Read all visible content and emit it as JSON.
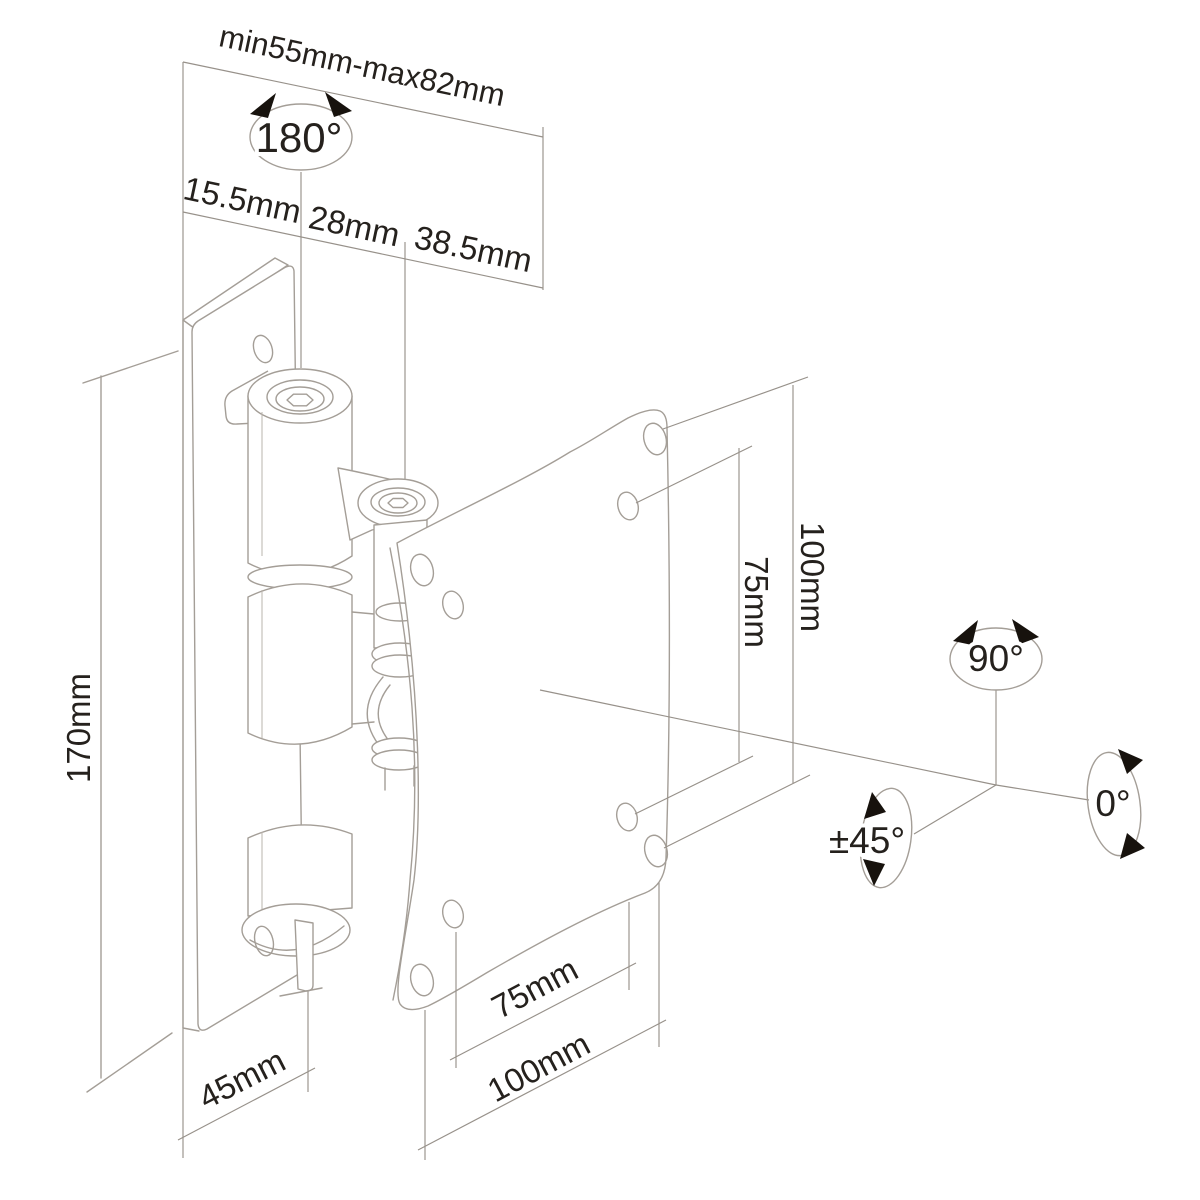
{
  "diagram": {
    "kind": "technical-dimension-drawing",
    "subject": "tilt-and-swivel monitor wall mount with VESA plate",
    "colors": {
      "background": "#ffffff",
      "drawing_line": "#a49e97",
      "dimension_line": "#97918a",
      "label_text": "#25211d",
      "arrow": "#17120d"
    }
  },
  "dimensions": {
    "depth_range": {
      "label": "min55mm-max82mm"
    },
    "offsets": [
      {
        "label": "15.5mm"
      },
      {
        "label": "28mm"
      },
      {
        "label": "38.5mm"
      }
    ],
    "wall_plate": {
      "height": {
        "label": "170mm"
      },
      "width": {
        "label": "45mm"
      }
    },
    "vesa_vertical": [
      {
        "label": "75mm"
      },
      {
        "label": "100mm"
      }
    ],
    "vesa_horizontal": [
      {
        "label": "75mm"
      },
      {
        "label": "100mm"
      }
    ]
  },
  "rotation_indicators": {
    "swivel": {
      "label": "180°"
    },
    "rotate": {
      "label": "90°"
    },
    "tilt": {
      "label": "±45°"
    },
    "neutral": {
      "label": "0°"
    }
  }
}
